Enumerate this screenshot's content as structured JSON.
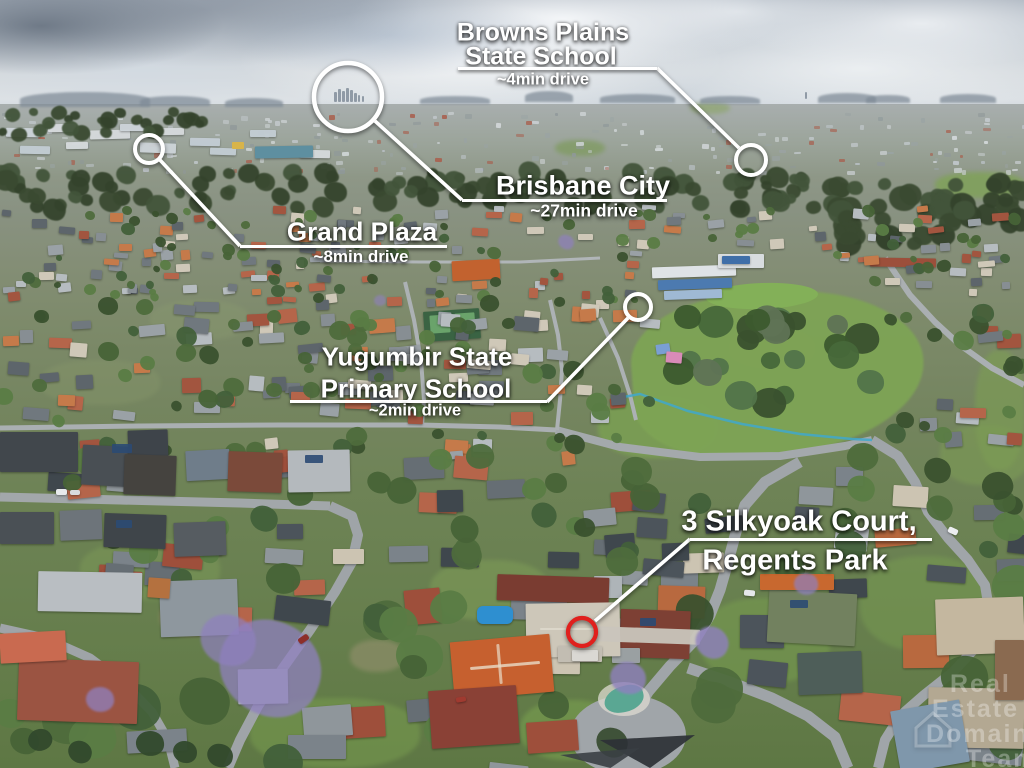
{
  "image_type": "aerial drone photograph of Regents Park suburb with location call-outs",
  "annotations": {
    "browns_plains": {
      "title_line1": "Browns Plains",
      "title_line2": "State School",
      "drive_time": "~4min drive"
    },
    "brisbane_city": {
      "title": "Brisbane City",
      "drive_time": "~27min drive"
    },
    "grand_plaza": {
      "title": "Grand Plaza",
      "drive_time": "~8min drive"
    },
    "yugumbir": {
      "title_line1": "Yugumbir State",
      "title_line2": "Primary School",
      "drive_time": "~2min drive"
    },
    "property": {
      "title_line1": "3 Silkyoak Court,",
      "title_line2": "Regents Park"
    }
  },
  "watermark": {
    "line1": "Real",
    "line2": "Estate",
    "line3": "Domain",
    "line4": "Team"
  },
  "colors": {
    "label_text": "#ffffff",
    "connector": "#ffffff",
    "property_marker": "#e0201d"
  }
}
